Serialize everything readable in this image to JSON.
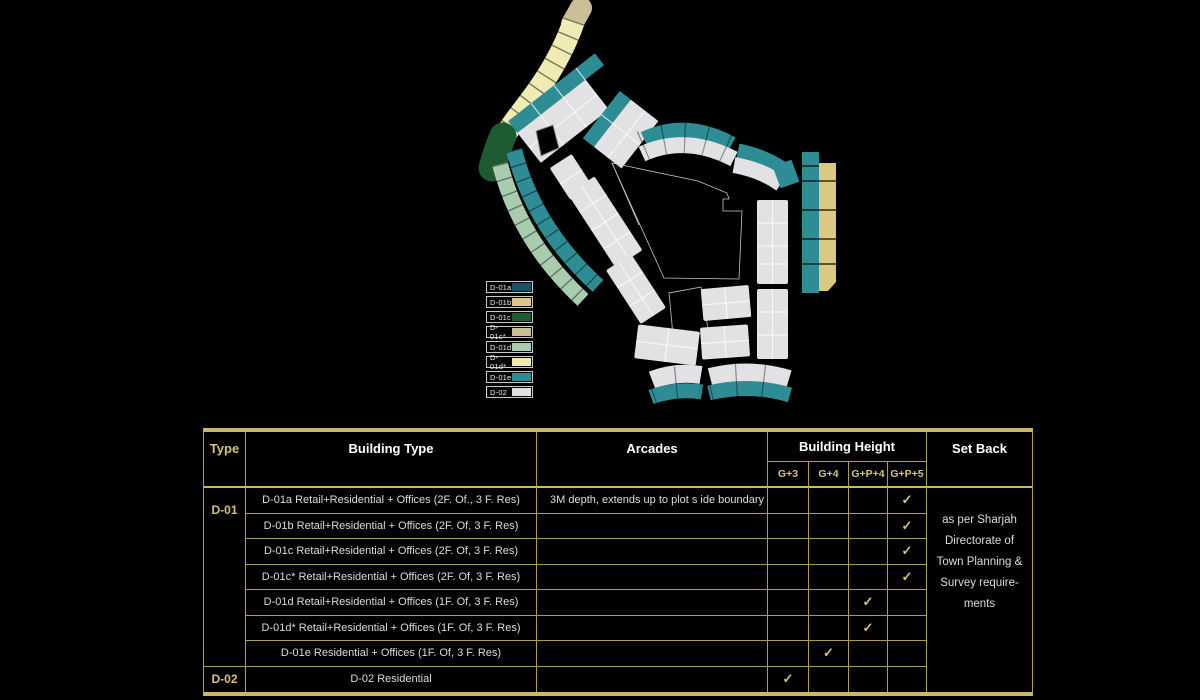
{
  "accent": {
    "gold_bar": "#C9BA68",
    "gold_line": "#AD9E52",
    "gold_text": "#D5C472",
    "row_text": "#DCDCDC",
    "header_text": "#FFFFFF"
  },
  "map": {
    "colors": {
      "d01a": "#155468",
      "d01b": "#DCC981",
      "d01c": "#1E5B31",
      "d01c_star": "#CCBF97",
      "d01d": "#A9CCAF",
      "d01d_star": "#EFEBB2",
      "d01e": "#2E8C94",
      "d02": "#E2E2E4",
      "outline": "#C8C8C8"
    }
  },
  "legend": {
    "items": [
      {
        "label": "D-01a",
        "color_key": "d01a"
      },
      {
        "label": "D-01b",
        "color_key": "d01b"
      },
      {
        "label": "D-01c",
        "color_key": "d01c"
      },
      {
        "label": "D-01c*",
        "color_key": "d01c_star"
      },
      {
        "label": "D-01d",
        "color_key": "d01d"
      },
      {
        "label": "D-01d*",
        "color_key": "d01d_star"
      },
      {
        "label": "D-01e",
        "color_key": "d01e"
      },
      {
        "label": "D-02",
        "color_key": "d02"
      }
    ]
  },
  "table": {
    "headers": {
      "type": "Type",
      "building_type": "Building Type",
      "arcades": "Arcades",
      "building_height": "Building Height",
      "set_back": "Set Back"
    },
    "height_options": [
      "G+3",
      "G+4",
      "G+P+4",
      "G+P+5"
    ],
    "check_glyph": "✓",
    "type_groups": [
      {
        "label": "D-01",
        "row_span": 7
      },
      {
        "label": "D-02",
        "row_span": 1
      }
    ],
    "rows": [
      {
        "building_type": "D-01a Retail+Residential + Offices (2F. Of., 3 F. Res)",
        "arcades": "3M depth, extends up to plot s ide boundary",
        "height": "G+P+5"
      },
      {
        "building_type": "D-01b Retail+Residential + Offices (2F. Of, 3 F. Res)",
        "arcades": "",
        "height": "G+P+5"
      },
      {
        "building_type": "D-01c Retail+Residential + Offices (2F. Of, 3 F. Res)",
        "arcades": "",
        "height": "G+P+5"
      },
      {
        "building_type": "D-01c* Retail+Residential + Offices (2F. Of, 3 F. Res)",
        "arcades": "",
        "height": "G+P+5"
      },
      {
        "building_type": "D-01d Retail+Residential + Offices (1F. Of, 3 F. Res)",
        "arcades": "",
        "height": "G+P+4"
      },
      {
        "building_type": "D-01d* Retail+Residential + Offices (1F. Of, 3 F. Res)",
        "arcades": "",
        "height": "G+P+4"
      },
      {
        "building_type": "D-01e Residential + Offices (1F. Of, 3 F. Res)",
        "arcades": "",
        "height": "G+4"
      },
      {
        "building_type": "D-02 Residential",
        "arcades": "",
        "height": "G+3"
      }
    ],
    "set_back_note_lines": [
      "as per Sharjah",
      "Directorate of",
      "Town Planning &",
      "Survey require-",
      "ments"
    ]
  }
}
